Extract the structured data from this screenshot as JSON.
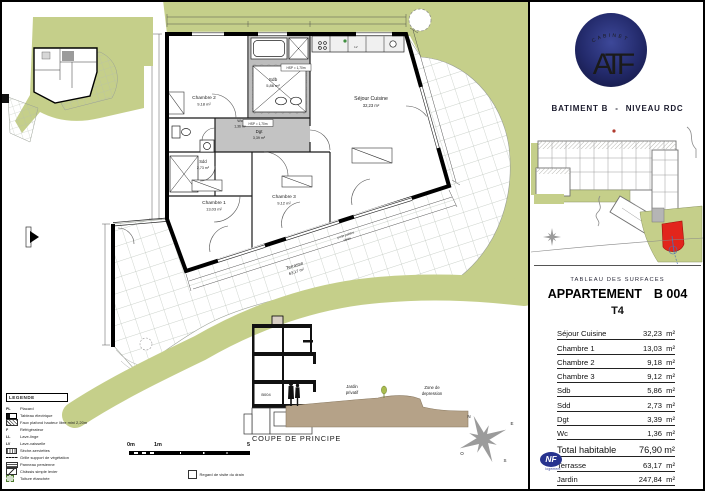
{
  "right_panel": {
    "logo": {
      "arc_text": "CABINET",
      "monogram": "ATF"
    },
    "building_title": "BATIMENT B",
    "title_separator": "-",
    "level_title": "NIVEAU RDC",
    "surfaces": {
      "section_title": "TABLEAU DES SURFACES",
      "apartment_label": "APPARTEMENT",
      "apartment_number": "B 004",
      "apartment_type": "T4",
      "rows": [
        {
          "label": "Séjour Cuisine",
          "value": "32,23",
          "unit": "m²"
        },
        {
          "label": "Chambre 1",
          "value": "13,03",
          "unit": "m²"
        },
        {
          "label": "Chambre 2",
          "value": "9,18",
          "unit": "m²"
        },
        {
          "label": "Chambre 3",
          "value": "9,12",
          "unit": "m²"
        },
        {
          "label": "Sdb",
          "value": "5,86",
          "unit": "m²"
        },
        {
          "label": "Sdd",
          "value": "2,73",
          "unit": "m²"
        },
        {
          "label": "Dgt",
          "value": "3,39",
          "unit": "m²"
        },
        {
          "label": "Wc",
          "value": "1,36",
          "unit": "m²"
        }
      ],
      "total_row": {
        "label": "Total habitable",
        "value": "76,90",
        "unit": "m²"
      },
      "outdoor_rows": [
        {
          "label": "Terrasse",
          "value": "63,17",
          "unit": "m²"
        },
        {
          "label": "Jardin",
          "value": "247,84",
          "unit": "m²"
        }
      ]
    },
    "nf_badge": {
      "text": "NF",
      "sub": "logement"
    }
  },
  "plan": {
    "rooms": {
      "chambre2": {
        "name": "Chambre 2",
        "area": "9,18 m²"
      },
      "sdb": {
        "name": "Sdb",
        "area": "5,86 m²"
      },
      "sejour": {
        "name": "Séjour Cuisine",
        "area": "32,23 m²"
      },
      "wc": {
        "name": "Wc",
        "area": "1,36 m²"
      },
      "dgt": {
        "name": "Dgt",
        "area": "3,39 m²"
      },
      "sdd": {
        "name": "Sdd",
        "area": "2,73 m²"
      },
      "chambre1": {
        "name": "Chambre 1",
        "area": "13,03 m²"
      },
      "chambre3": {
        "name": "Chambre 3",
        "area": "9,12 m²"
      },
      "terrasse": {
        "name": "Terrasse",
        "area": "63,17 m²"
      }
    },
    "facade_note_line1": "porte palière",
    "facade_note_line2": "vitrée",
    "hsp_note": "HSP = 1,70m",
    "kitchen_marks": {
      "f": "F",
      "lv": "LV"
    }
  },
  "coupe": {
    "title": "COUPE DE PRINCIPE",
    "unit": "B004",
    "garden_line1": "Jardin",
    "garden_line2": "privatif",
    "zone_line1": "Zone de",
    "zone_line2": "depression"
  },
  "legend": {
    "title": "LEGENDE",
    "items": [
      {
        "sym": "PL",
        "label": "Placard"
      },
      {
        "sym": "",
        "label": "Tableau électrique"
      },
      {
        "sym": "",
        "label": "Faux plafond hauteur libre mini 2,20m"
      },
      {
        "sym": "F",
        "label": "Réfrigérateur"
      },
      {
        "sym": "LL",
        "label": "Lave-linge"
      },
      {
        "sym": "LV",
        "label": "Lave-vaisselle"
      },
      {
        "sym": "",
        "label": "Sèche-serviettes"
      },
      {
        "sym": "",
        "label": "Grille support de végétation"
      },
      {
        "sym": "",
        "label": "Panneau persienne"
      },
      {
        "sym": "",
        "label": "Châssis simple levier"
      },
      {
        "sym": "",
        "label": "Toiture étanchée"
      },
      {
        "sym": "",
        "label": "Regard de visite du drain"
      }
    ]
  },
  "scale": {
    "t0": "0m",
    "t1": "1m",
    "t5": "5"
  },
  "compass": {
    "n": "N",
    "e": "E",
    "s": "S",
    "o": "O"
  },
  "colors": {
    "garden_green": "#c5cf8a",
    "logo_navy": "#232a6b",
    "unit_red": "#e2251c",
    "ground_brown": "#b5a288"
  }
}
